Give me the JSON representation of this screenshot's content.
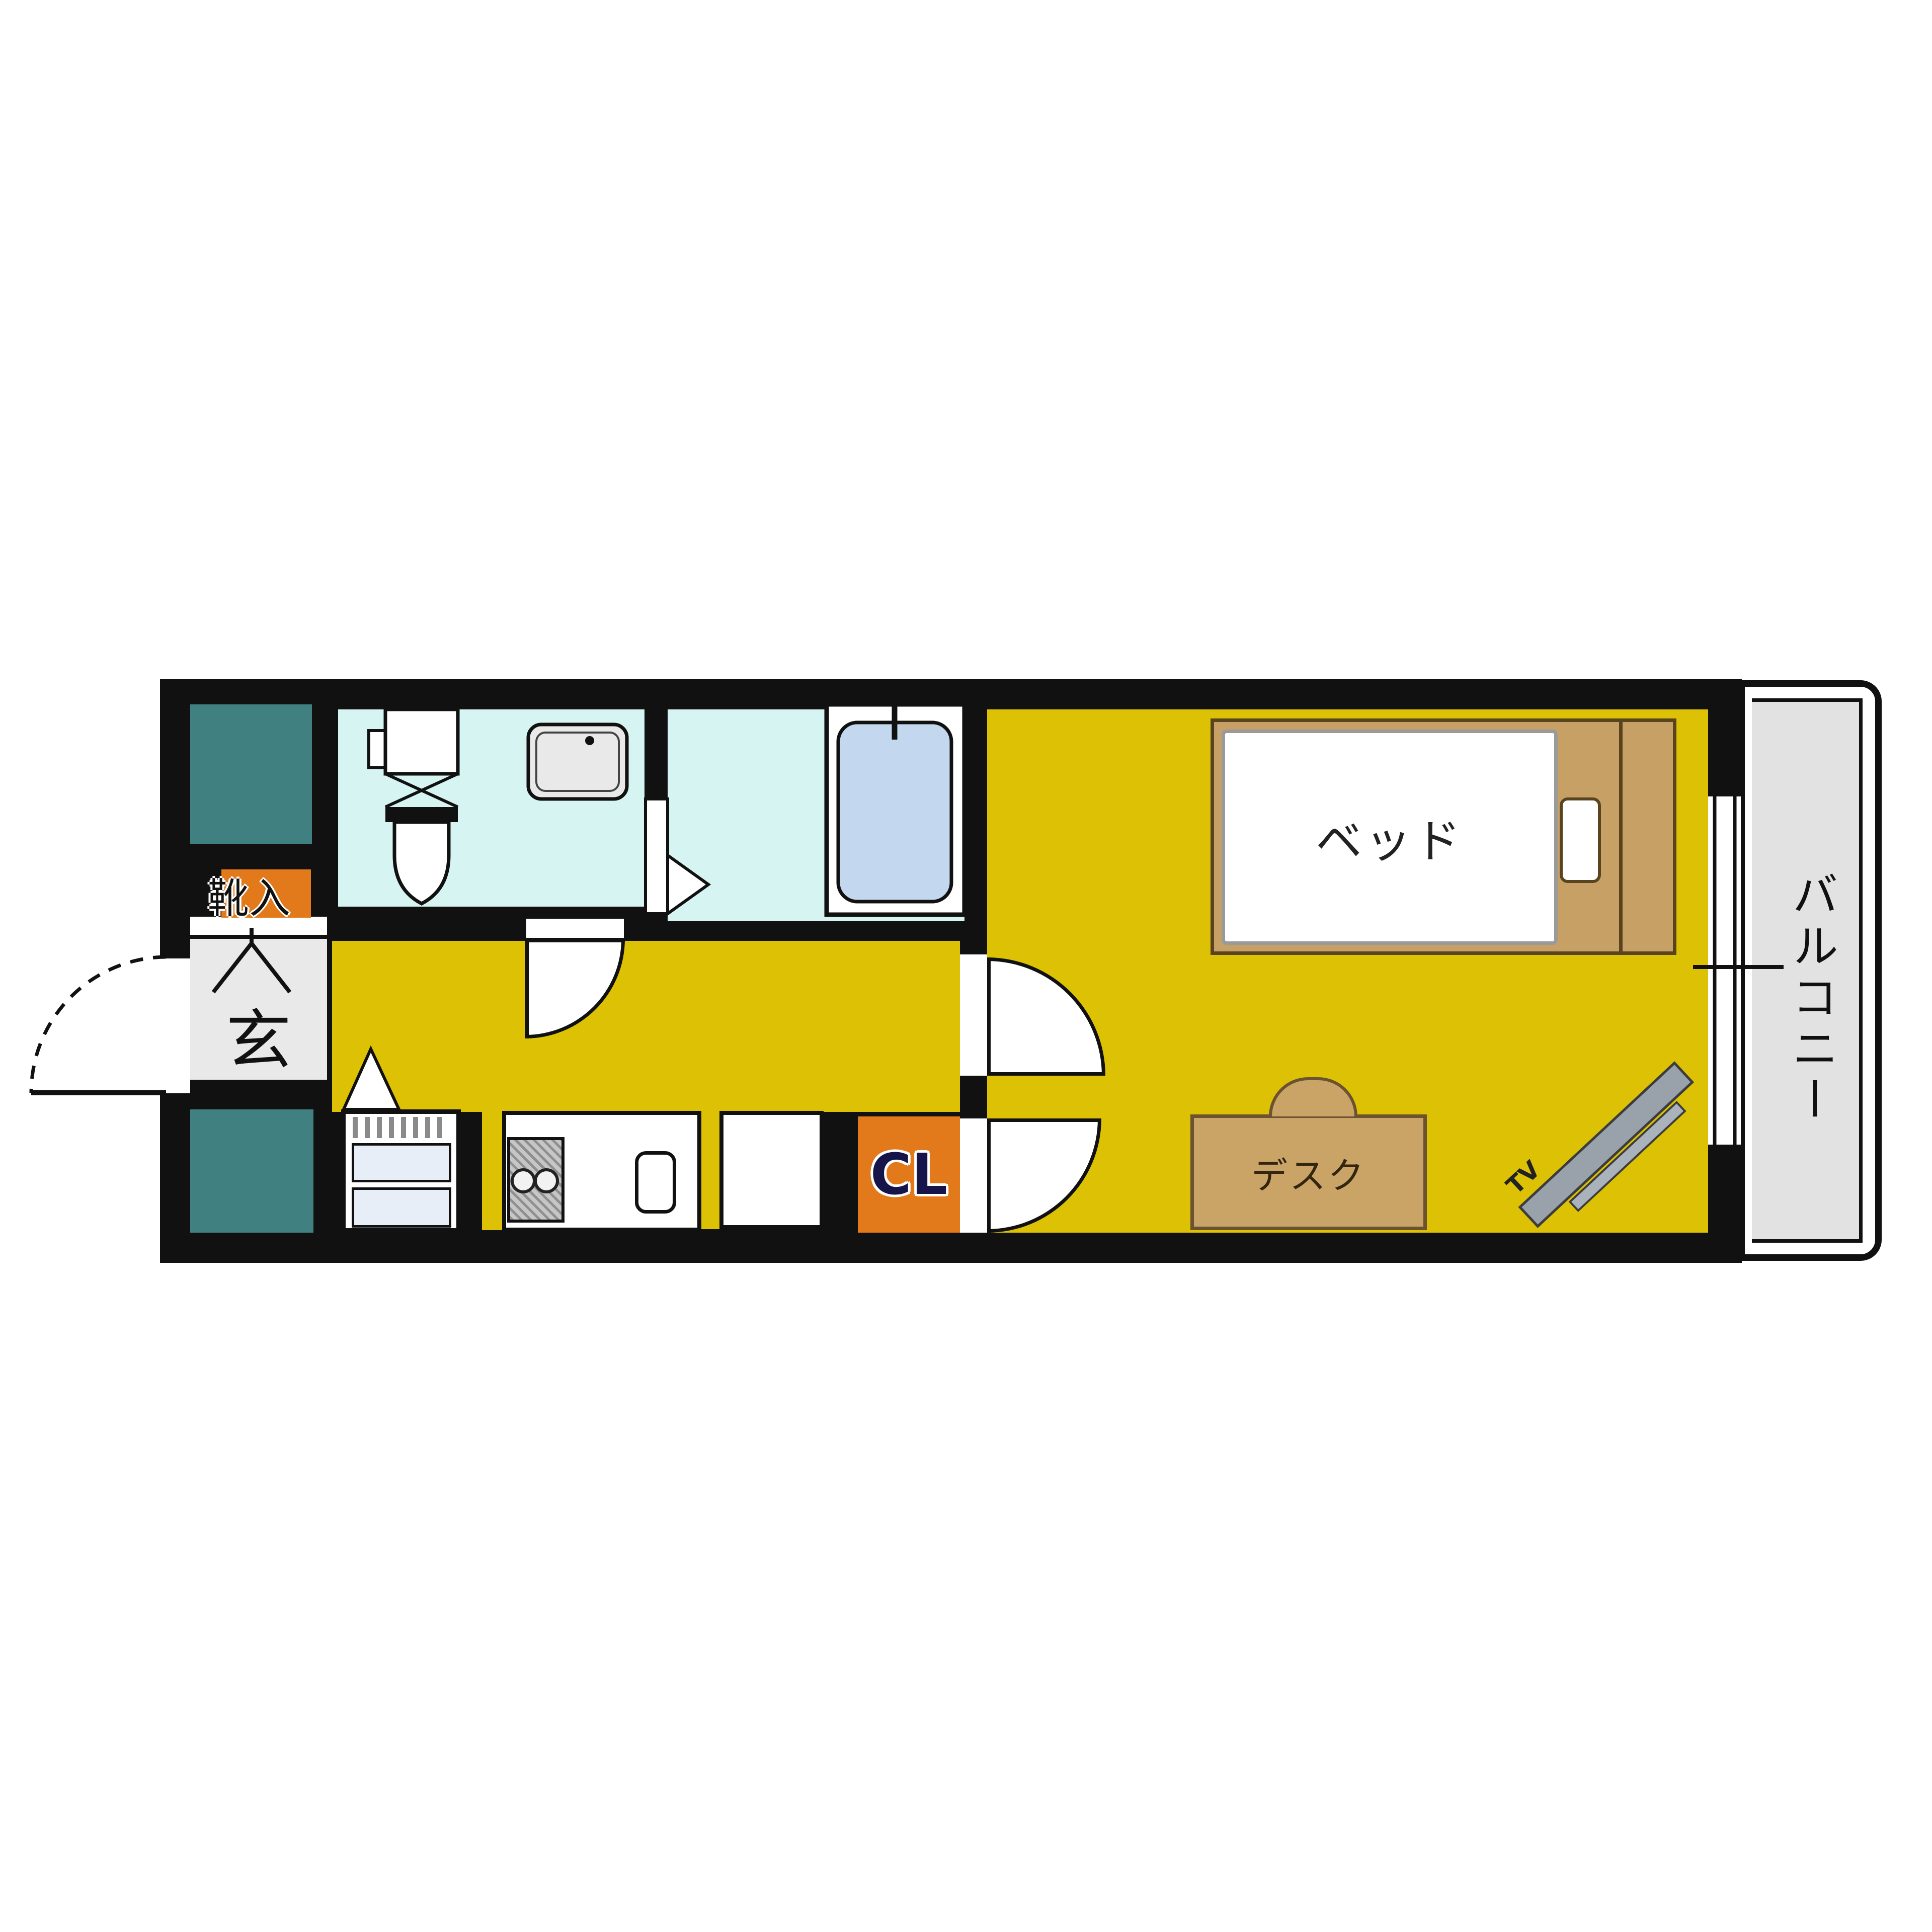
{
  "floorplan": {
    "labels": {
      "bed": "ベッド",
      "desk": "デスク",
      "tv": "TV",
      "closet": "CL",
      "balcony": "バルコニー",
      "entrance": "玄",
      "shoe_cabinet": "靴入"
    },
    "colors": {
      "flooring_yellow": "#dcc104",
      "wet_area_cyan": "#d6f4f2",
      "bathtub_blue": "#c3d8ee",
      "teal_fixture": "#418080",
      "accent_orange": "#e2791a",
      "balcony_gray": "#e2e2e2",
      "entrance_gray": "#e9e9e9",
      "bed_frame_tan": "#c7a065",
      "desk_tan": "#c9a466",
      "tv_gray": "#99a1ab",
      "wall_black": "#111111"
    }
  }
}
